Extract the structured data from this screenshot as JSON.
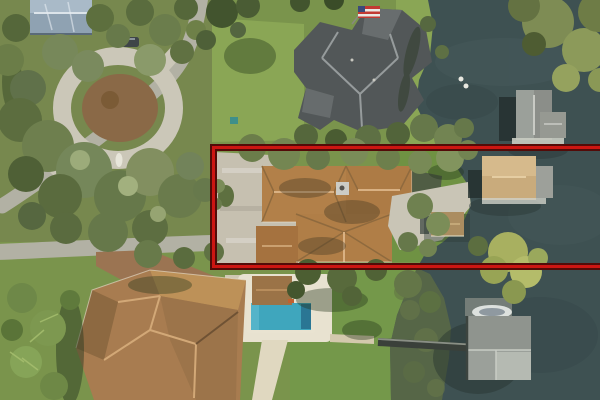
{
  "meta": {
    "type": "aerial-photo",
    "description": "Aerial drone view of lakefront residential properties; one waterfront parcel is outlined with a red rectangle annotation open toward the right image edge"
  },
  "annotation": {
    "kind": "property-boundary-highlight",
    "shape": "rectangle-outline",
    "x": 210,
    "y": 144,
    "width": 400,
    "height": 126
  },
  "objects": {
    "highlighted_parcel": "single-story home, brown shingle roof, paver driveway, lakefront with covered dock and tan boathouse",
    "top_left": "home with blue-gray metal roof, circular concrete driveway with mulch island and statue, parked car",
    "top_center": "large home with dark gray roof and US flag",
    "top_right": "lawn to shoreline, gray-roof boathouse",
    "bottom_left": "large home with brown tile roof, paver driveway, palm trees",
    "bottom_center": "swimming pool with cabana and yellow umbrella",
    "bottom_right": "gray-roof boathouse with docked boat and long walkway pier",
    "water": "dark lake occupying right side"
  },
  "colors": {
    "lawn_base": "#7a944c",
    "lawn_bright": "#8aa655",
    "lawn_mid": "#74984a",
    "olive_ground": "#77884e",
    "water": "#3e5152",
    "water_shallow": "#5d6b45",
    "road": "#b2b1a4",
    "concrete": "#cbc7b8",
    "paver_driveway": "#c6c0b0",
    "brown_driveway": "#9b7452",
    "mulch": "#8a6947",
    "roof_highlight_house": "#b28049",
    "roof_highlight_ridge": "#d9b183",
    "roof_dark_house": "#525758",
    "roof_dark_ridge": "#a2a8a8",
    "roof_tile_house": "#a87c50",
    "roof_blue_metal": "#8fa2b2",
    "boathouse_gray": "#9ba09a",
    "boathouse_tan": "#c9ab7c",
    "dock_brown": "#ab8d60",
    "pool_water": "#3fa6bd",
    "pool_deck": "#e8e2d0",
    "umbrella_yellow": "#d4b42c",
    "flag_red": "#c23a33",
    "boat_white": "#dde1de",
    "highlight_outer": "#530b08",
    "highlight_inner": "#cc1612"
  }
}
